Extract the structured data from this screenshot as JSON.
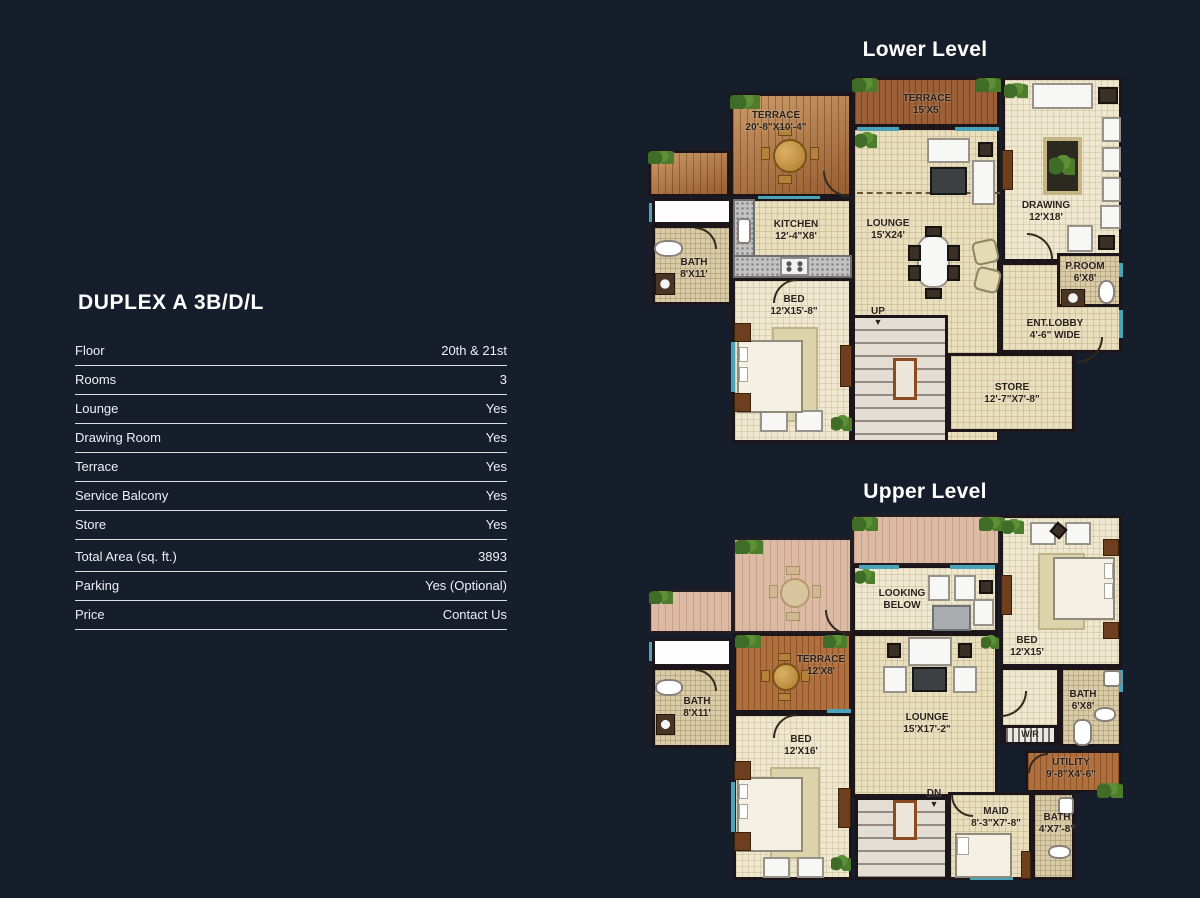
{
  "colors": {
    "background": "#161d2b",
    "text": "#edf1f6",
    "accent_teal": "#4aa3b8",
    "wood": "#b57a46",
    "floor_tile": "#e9dfbd",
    "wall": "#1c161b"
  },
  "spec_panel": {
    "title": "DUPLEX A 3B/D/L",
    "rows": [
      {
        "label": "Floor",
        "value": "20th & 21st"
      },
      {
        "label": "Rooms",
        "value": "3"
      },
      {
        "label": "Lounge",
        "value": "Yes"
      },
      {
        "label": "Drawing Room",
        "value": "Yes"
      },
      {
        "label": "Terrace",
        "value": "Yes"
      },
      {
        "label": "Service Balcony",
        "value": "Yes"
      },
      {
        "label": "Store",
        "value": "Yes"
      },
      {
        "label": "Total Area (sq. ft.)",
        "value": "3893"
      },
      {
        "label": "Parking",
        "value": "Yes (Optional)"
      },
      {
        "label": "Price",
        "value": "Contact Us"
      }
    ]
  },
  "lower_level": {
    "title": "Lower Level",
    "rooms": [
      {
        "name": "TERRACE",
        "dims": "20'-8\"X10'-4\""
      },
      {
        "name": "TERRACE",
        "dims": "15'X5'"
      },
      {
        "name": "DRAWING",
        "dims": "12'X18'"
      },
      {
        "name": "KITCHEN",
        "dims": "12'-4\"X8'"
      },
      {
        "name": "LOUNGE",
        "dims": "15'X24'"
      },
      {
        "name": "BATH",
        "dims": "8'X11'"
      },
      {
        "name": "BED",
        "dims": "12'X15'-8\""
      },
      {
        "name": "P.ROOM",
        "dims": "6'X8'"
      },
      {
        "name": "ENT.LOBBY",
        "dims": "4'-6\" WIDE"
      },
      {
        "name": "STORE",
        "dims": "12'-7\"X7'-8\""
      },
      {
        "name": "UP",
        "arrow": "▼"
      }
    ]
  },
  "upper_level": {
    "title": "Upper Level",
    "rooms": [
      {
        "name": "LOOKING BELOW"
      },
      {
        "name": "BED",
        "dims": "12'X15'"
      },
      {
        "name": "BATH",
        "dims": "6'X8'"
      },
      {
        "name": "W/R"
      },
      {
        "name": "UTILITY",
        "dims": "9'-8\"X4'-6\""
      },
      {
        "name": "TERRACE",
        "dims": "12'X8'"
      },
      {
        "name": "BATH",
        "dims": "8'X11'"
      },
      {
        "name": "BED",
        "dims": "12'X16'"
      },
      {
        "name": "LOUNGE",
        "dims": "15'X17'-2\""
      },
      {
        "name": "DN",
        "arrow": "▼"
      },
      {
        "name": "MAID",
        "dims": "8'-3\"X7'-8\""
      },
      {
        "name": "BATH",
        "dims": "4'X7'-8\""
      }
    ]
  }
}
